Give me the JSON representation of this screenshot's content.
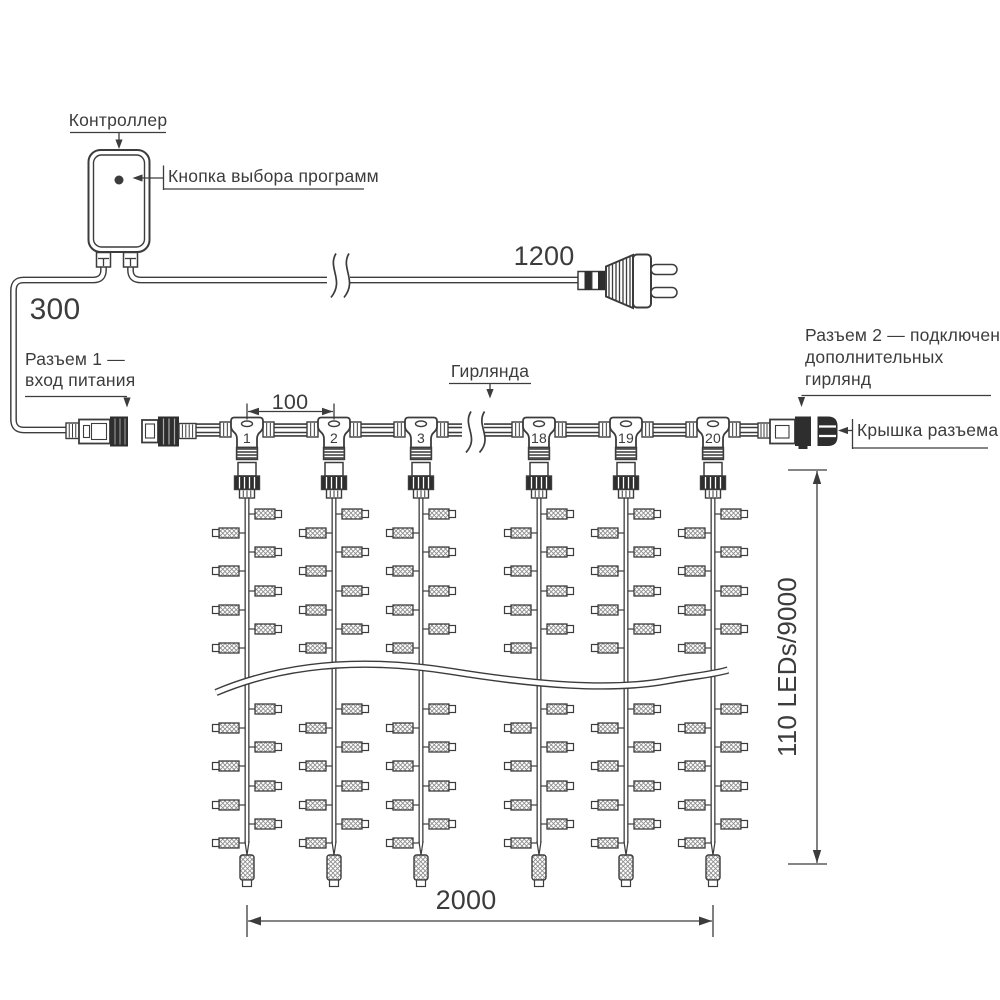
{
  "labels": {
    "controller": "Контроллер",
    "program_button": "Кнопка выбора программ",
    "connector1_line1": "Разъем 1 —",
    "connector1_line2": "вход питания",
    "garland": "Гирлянда",
    "connector2_line1": "Разъем 2 — подключение",
    "connector2_line2": "дополнительных",
    "connector2_line3": "гирлянд",
    "connector_cap": "Крышка разъема"
  },
  "dimensions": {
    "left_lead_length": "300",
    "power_cord_length": "1200",
    "drop_spacing": "100",
    "curtain_width": "2000",
    "curtain_height": "110 LEDs/9000"
  },
  "curtain": {
    "drop_labels": [
      "1",
      "2",
      "3",
      "18",
      "19",
      "20"
    ]
  },
  "colors": {
    "ink": "#3c3c3c",
    "dark_fill": "#2e2e2e",
    "background": "#ffffff"
  }
}
